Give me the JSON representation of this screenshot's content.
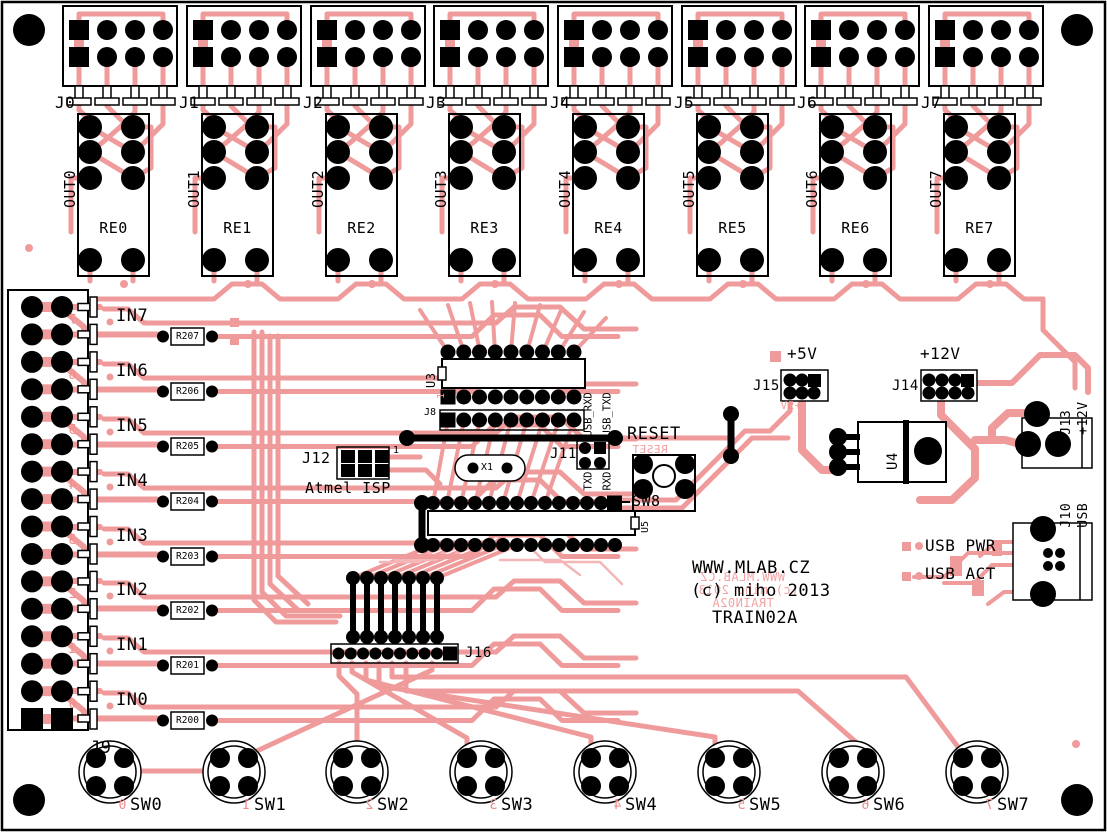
{
  "board": {
    "website": "WWW.MLAB.CZ",
    "copyright": "(c) miho 2013",
    "name": "TRAIN02A",
    "mirror": {
      "website": "WWW.MLAB.CZ",
      "copyright": "(c) miho 2013",
      "name": "TRAIN02A"
    },
    "colors": {
      "trace": "#F09B9B",
      "silkscreen": "#000000",
      "board": "#FFFFFF"
    }
  },
  "relay_channels": [
    {
      "connector": "J0",
      "output": "OUT0",
      "relay": "RE0"
    },
    {
      "connector": "J1",
      "output": "OUT1",
      "relay": "RE1"
    },
    {
      "connector": "J2",
      "output": "OUT2",
      "relay": "RE2"
    },
    {
      "connector": "J3",
      "output": "OUT3",
      "relay": "RE3"
    },
    {
      "connector": "J4",
      "output": "OUT4",
      "relay": "RE4"
    },
    {
      "connector": "J5",
      "output": "OUT5",
      "relay": "RE5"
    },
    {
      "connector": "J6",
      "output": "OUT6",
      "relay": "RE6"
    },
    {
      "connector": "J7",
      "output": "OUT7",
      "relay": "RE7"
    }
  ],
  "input_channels": [
    {
      "label": "IN7",
      "resistor": "R207",
      "pin_number": "7"
    },
    {
      "label": "IN6",
      "resistor": "R206",
      "pin_number": "6"
    },
    {
      "label": "IN5",
      "resistor": "R205",
      "pin_number": "5"
    },
    {
      "label": "IN4",
      "resistor": "R204",
      "pin_number": "4"
    },
    {
      "label": "IN3",
      "resistor": "R203",
      "pin_number": "3"
    },
    {
      "label": "IN2",
      "resistor": "R202",
      "pin_number": "2"
    },
    {
      "label": "IN1",
      "resistor": "R201",
      "pin_number": "1"
    },
    {
      "label": "IN0",
      "resistor": "R200",
      "pin_number": "0"
    }
  ],
  "left_connector": {
    "label": "J9"
  },
  "switches": [
    {
      "label": "SW0",
      "number": "0"
    },
    {
      "label": "SW1",
      "number": "1"
    },
    {
      "label": "SW2",
      "number": "2"
    },
    {
      "label": "SW3",
      "number": "3"
    },
    {
      "label": "SW4",
      "number": "4"
    },
    {
      "label": "SW5",
      "number": "5"
    },
    {
      "label": "SW6",
      "number": "6"
    },
    {
      "label": "SW7",
      "number": "7"
    }
  ],
  "center": {
    "driver_ic": "U3",
    "driver_pin1": "1",
    "header_j8": "J8",
    "usb_rxd": "USB_RXD",
    "usb_txd": "USB_TXD",
    "serial_header": "J11",
    "txd": "TXD",
    "rxd": "RXD",
    "crystal": "X1",
    "isp_header": "J12",
    "isp_pin1": "1",
    "isp_caption": "Atmel ISP",
    "reset_label": "RESET",
    "reset_mirror": "RESET",
    "reset_switch": "SW8",
    "mcu": "U5",
    "jumper_header": "J16"
  },
  "power": {
    "v5_label": "+5V",
    "v5_mirror": "+5V",
    "v5_header": "J15",
    "v12_label": "+12V",
    "v12_header": "J14",
    "regulator": "U4",
    "dc_jack_label": "J13",
    "dc_jack_sub": "+12V",
    "usb_conn_label": "J10",
    "usb_conn_sub": "USB",
    "usb_pwr": "USB PWR",
    "usb_act": "USB ACT"
  }
}
